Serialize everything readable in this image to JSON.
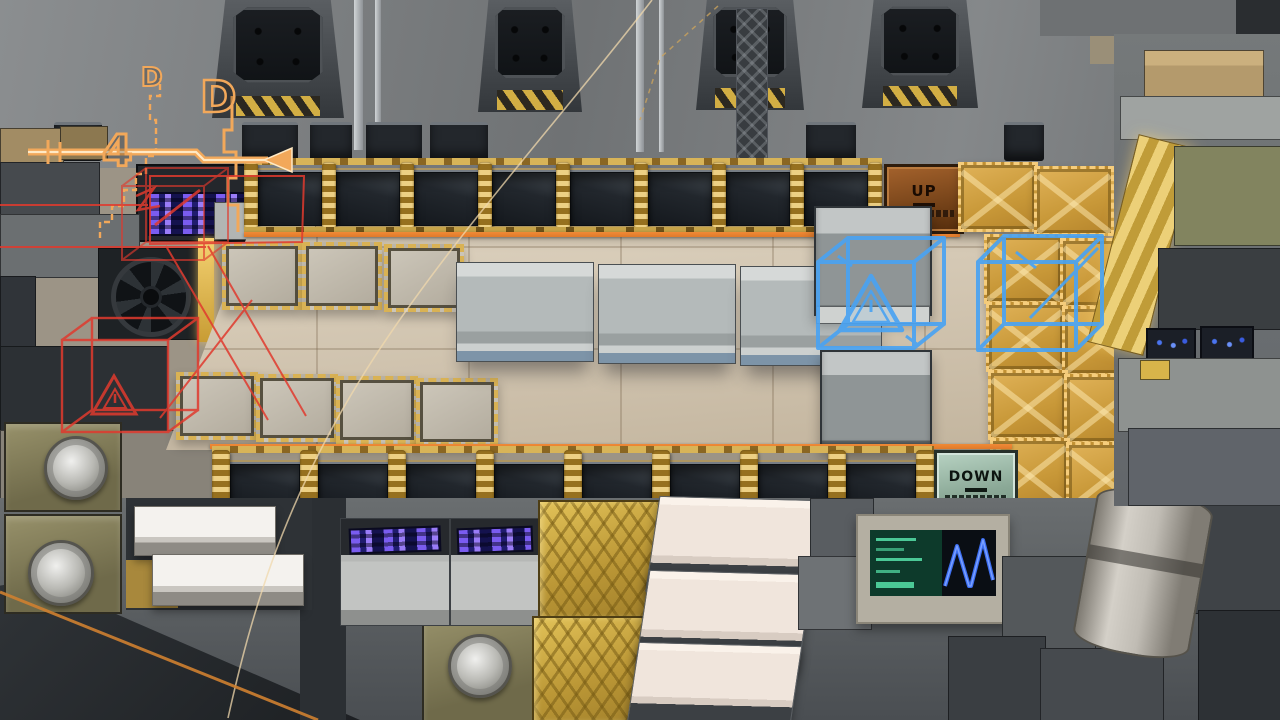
{
  "scene": {
    "description": "isometric sci-fi factory floor",
    "elevator_up": {
      "label": "UP"
    },
    "elevator_down": {
      "label": "DOWN"
    },
    "path_annotation": {
      "letter_small": "D",
      "letter_large": "D",
      "digit": "4"
    },
    "icons": {
      "warning_triangle": "⚠",
      "left_arrow": "◀",
      "fan": "⊙",
      "welder_disc": "◎",
      "waveform": "ΛΛ"
    },
    "colors": {
      "wall": "#9c9486",
      "top_bg_1": "#8b8e90",
      "top_bg_2": "#6f7274",
      "floor": "#d5c8b4",
      "pit": "#22272d",
      "gold": "#c9a23f",
      "gold_bright": "#e8c56c",
      "hazard": "#d4a246",
      "accent_orange": "#df7a2b",
      "path_orange": "#f2a85a",
      "path_cream": "#ffe9c4",
      "wire_blue": "#4aa3f2",
      "wire_red": "#e03a2e",
      "up_tile": "#8a5226",
      "down_tile": "#9dbcab",
      "metal_light": "#b9bcbb",
      "metal_mid": "#83888a",
      "metal_dark": "#3a3f43",
      "olive": "#8b865f",
      "slab_cream": "#f1e7de",
      "conveyor_gold": "#c9a63d",
      "screen_purple": "#6a54e8",
      "screen_green_bg": "#0d3a2b",
      "screen_green_fg": "#57e2a9",
      "screen_wave_bg": "#0a0e14",
      "screen_wave": "#3c6ef2"
    }
  }
}
